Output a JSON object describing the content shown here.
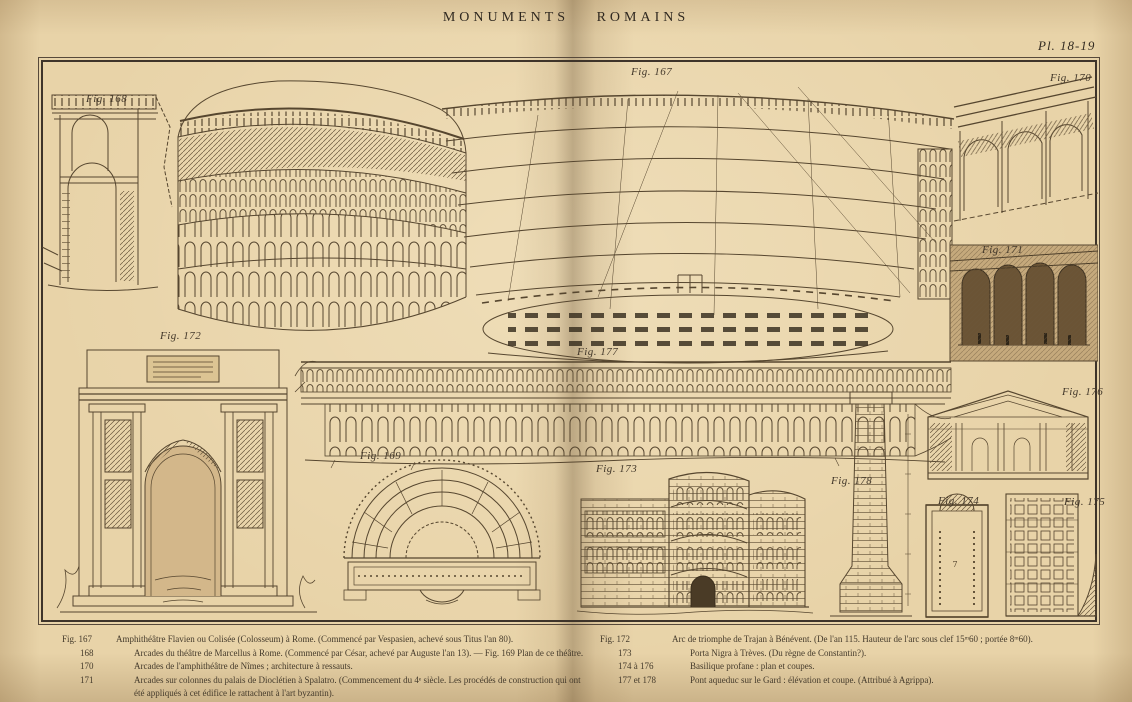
{
  "page": {
    "title": "MONUMENTS ROMAINS",
    "plate": "Pl. 18-19"
  },
  "colors": {
    "paper": "#e8d3a8",
    "ink": "#56462f",
    "text_ink": "#443a2b",
    "frame": "#3e342a"
  },
  "figure_labels": {
    "fig167": "Fig. 167",
    "fig168": "Fig. 168",
    "fig169": "Fig. 169",
    "fig170": "Fig. 170",
    "fig171": "Fig. 171",
    "fig172": "Fig. 172",
    "fig173": "Fig. 173",
    "fig174": "Fig. 174",
    "fig175": "Fig. 175",
    "fig176": "Fig. 176",
    "fig177": "Fig. 177",
    "fig178": "Fig. 178"
  },
  "captions": {
    "left": [
      {
        "ref": "Fig. 167",
        "text": "Amphithéâtre Flavien ou Colisée (Colosseum) à Rome. (Commencé par Vespasien, achevé sous Titus l'an 80)."
      },
      {
        "ref": "168",
        "text": "Arcades du théâtre de Marcellus à Rome. (Commencé par César, achevé par Auguste l'an 13). — Fig. 169 Plan de ce théâtre."
      },
      {
        "ref": "170",
        "text": "Arcades de l'amphithéâtre de Nîmes ; architecture à ressauts."
      },
      {
        "ref": "171",
        "text": "Arcades sur colonnes du palais de Dioclétien à Spalatro. (Commencement du 4ᵉ siècle. Les procédés de construction qui ont été appliqués à cet édifice le rattachent à l'art byzantin)."
      }
    ],
    "right": [
      {
        "ref": "Fig. 172",
        "text": "Arc de triomphe de Trajan à Bénévent. (De l'an 115. Hauteur de l'arc sous clef 15ᵐ60 ; portée 8ᵐ60)."
      },
      {
        "ref": "173",
        "text": "Porta Nigra à Trèves. (Du règne de Constantin?)."
      },
      {
        "ref": "174 à 176",
        "text": "Basilique profane : plan et coupes."
      },
      {
        "ref": "177 et 178",
        "text": "Pont aqueduc sur le Gard : élévation et coupe. (Attribué à Agrippa)."
      }
    ]
  }
}
